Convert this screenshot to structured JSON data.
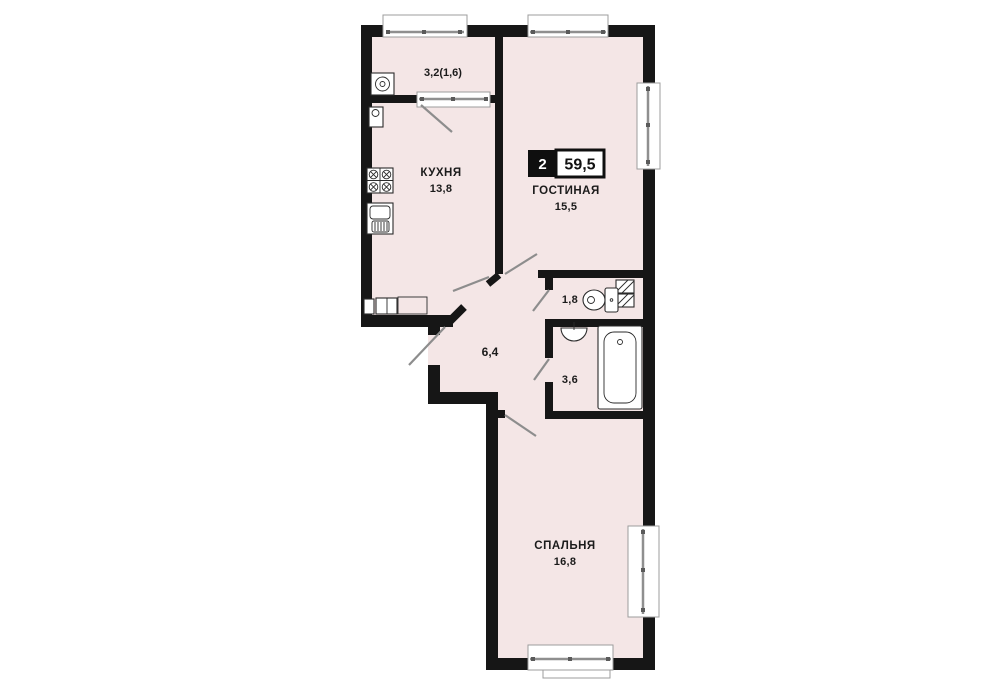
{
  "badge": {
    "room_count": "2",
    "total_area": "59,5"
  },
  "rooms": {
    "balcony": {
      "area_label": "3,2(1,6)"
    },
    "kitchen": {
      "name": "КУХНЯ",
      "area": "13,8"
    },
    "living_room": {
      "name": "ГОСТИНАЯ",
      "area": "15,5"
    },
    "wc": {
      "area": "1,8"
    },
    "bathroom": {
      "area": "3,6"
    },
    "hallway": {
      "area": "6,4"
    },
    "bedroom": {
      "name": "СПАЛЬНЯ",
      "area": "16,8"
    }
  },
  "colors": {
    "floor": "#f4e6e6",
    "walls": "#161616",
    "background": "#ffffff",
    "badge_box": "#0f0f0f",
    "window_frame": "#8f8f8f"
  }
}
